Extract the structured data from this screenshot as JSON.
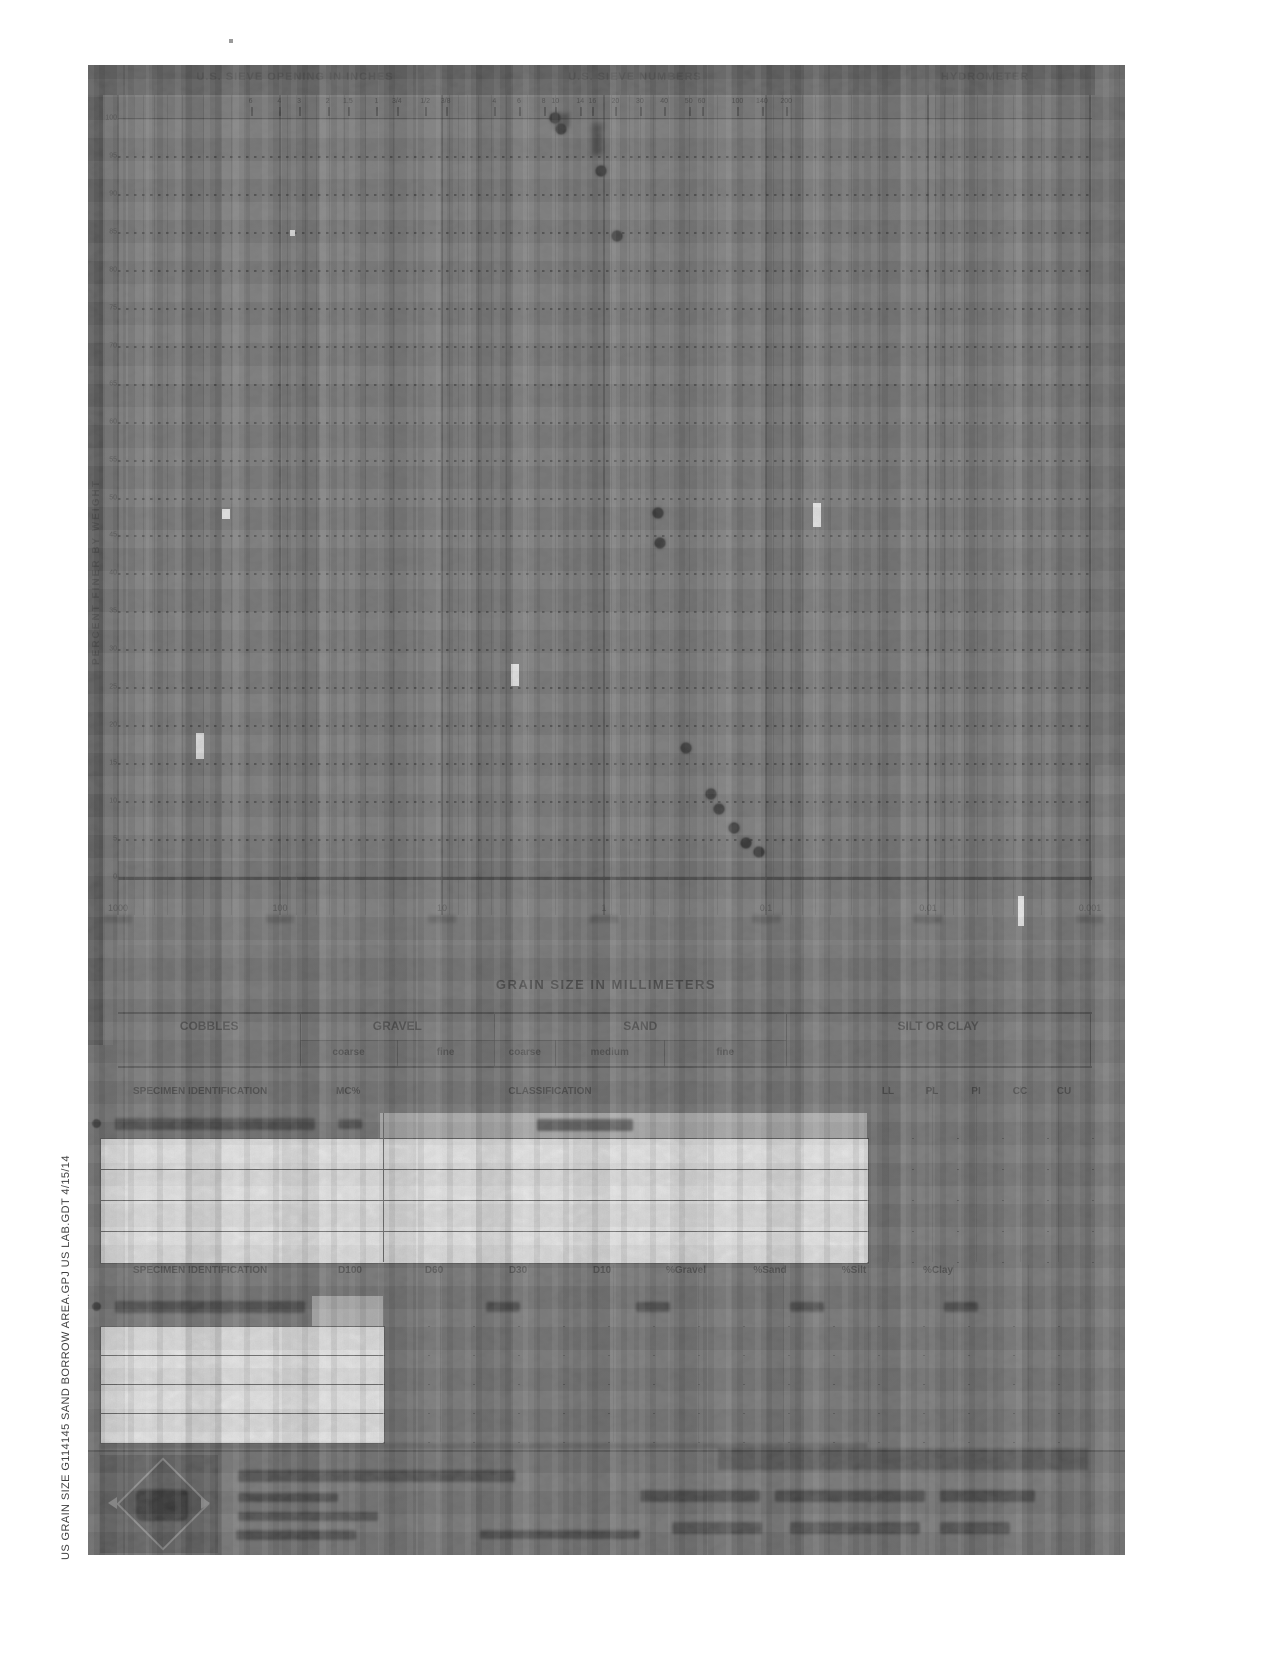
{
  "document": {
    "sidebar_filename": "US  GRAIN  SIZE   G114145 SAND BORROW AREA.GPJ   US  LAB.GDT   4/15/14"
  },
  "chart": {
    "header_left": "U.S. SIEVE OPENING IN INCHES",
    "header_center": "U.S. SIEVE NUMBERS",
    "header_right": "HYDROMETER",
    "ylabel": "PERCENT FINER BY WEIGHT",
    "xlabel": "GRAIN SIZE IN MILLIMETERS",
    "x_tick_labels": [
      "1000",
      "100",
      "10",
      "1",
      "0.1",
      "0.01",
      "0.001"
    ],
    "y_tick_labels": [
      "100",
      "95",
      "90",
      "85",
      "80",
      "75",
      "70",
      "65",
      "60",
      "55",
      "50",
      "45",
      "40",
      "35",
      "30",
      "25",
      "20",
      "15",
      "10",
      "5",
      "0"
    ],
    "sieve_ticks": [
      {
        "label": "6",
        "mm": 152
      },
      {
        "label": "4",
        "mm": 101
      },
      {
        "label": "3",
        "mm": 76.2
      },
      {
        "label": "2",
        "mm": 50.8
      },
      {
        "label": "1.5",
        "mm": 38.1
      },
      {
        "label": "1",
        "mm": 25.4
      },
      {
        "label": "3/4",
        "mm": 19
      },
      {
        "label": "1/2",
        "mm": 12.7
      },
      {
        "label": "3/8",
        "mm": 9.5
      },
      {
        "label": "4",
        "mm": 4.75
      },
      {
        "label": "6",
        "mm": 3.35
      },
      {
        "label": "8",
        "mm": 2.36
      },
      {
        "label": "10",
        "mm": 2
      },
      {
        "label": "14",
        "mm": 1.4
      },
      {
        "label": "16",
        "mm": 1.18
      },
      {
        "label": "20",
        "mm": 0.85
      },
      {
        "label": "30",
        "mm": 0.6
      },
      {
        "label": "40",
        "mm": 0.425
      },
      {
        "label": "50",
        "mm": 0.3
      },
      {
        "label": "60",
        "mm": 0.25
      },
      {
        "label": "100",
        "mm": 0.15
      },
      {
        "label": "140",
        "mm": 0.106
      },
      {
        "label": "200",
        "mm": 0.075
      }
    ]
  },
  "classification_bar": {
    "groups": [
      {
        "label": "COBBLES",
        "from_mm": 1000,
        "to_mm": 75,
        "sub": []
      },
      {
        "label": "GRAVEL",
        "from_mm": 75,
        "to_mm": 4.75,
        "sub": [
          {
            "label": "coarse",
            "to_mm": 19
          },
          {
            "label": "fine",
            "to_mm": 4.75
          }
        ]
      },
      {
        "label": "SAND",
        "from_mm": 4.75,
        "to_mm": 0.075,
        "sub": [
          {
            "label": "coarse",
            "to_mm": 2
          },
          {
            "label": "medium",
            "to_mm": 0.425
          },
          {
            "label": "fine",
            "to_mm": 0.075
          }
        ]
      },
      {
        "label": "SILT OR CLAY",
        "from_mm": 0.075,
        "to_mm": 0.001,
        "sub": []
      }
    ]
  },
  "chart_data": {
    "type": "scatter",
    "title": "Gradation curves (scanned, mostly illegible)",
    "xlabel": "GRAIN SIZE IN MILLIMETERS",
    "ylabel": "PERCENT FINER BY WEIGHT",
    "x_scale": "log",
    "xlim": [
      1000,
      0.001
    ],
    "ylim": [
      0,
      100
    ],
    "grid": "on",
    "series": [
      {
        "name": "specimen-curve-1",
        "points_mm_pctfiner": [
          [
            2.0,
            100
          ],
          [
            1.85,
            98.5
          ],
          [
            1.05,
            93
          ],
          [
            0.83,
            84.5
          ]
        ]
      },
      {
        "name": "specimen-curve-2",
        "points_mm_pctfiner": [
          [
            0.465,
            48
          ],
          [
            0.45,
            44
          ],
          [
            0.31,
            17
          ],
          [
            0.22,
            11
          ],
          [
            0.195,
            9
          ],
          [
            0.158,
            6.5
          ],
          [
            0.132,
            4.5
          ],
          [
            0.11,
            3.3
          ]
        ]
      }
    ]
  },
  "table1": {
    "header_specimen": "SPECIMEN IDENTIFICATION",
    "header_mc": "MC%",
    "header_classification": "CLASSIFICATION",
    "right_cols": [
      "LL",
      "PL",
      "PI",
      "CC",
      "CU"
    ]
  },
  "table2": {
    "header_specimen": "SPECIMEN IDENTIFICATION",
    "cols": [
      "D100",
      "D60",
      "D30",
      "D10",
      "%Gravel",
      "%Sand",
      "%Silt",
      "%Clay"
    ]
  }
}
